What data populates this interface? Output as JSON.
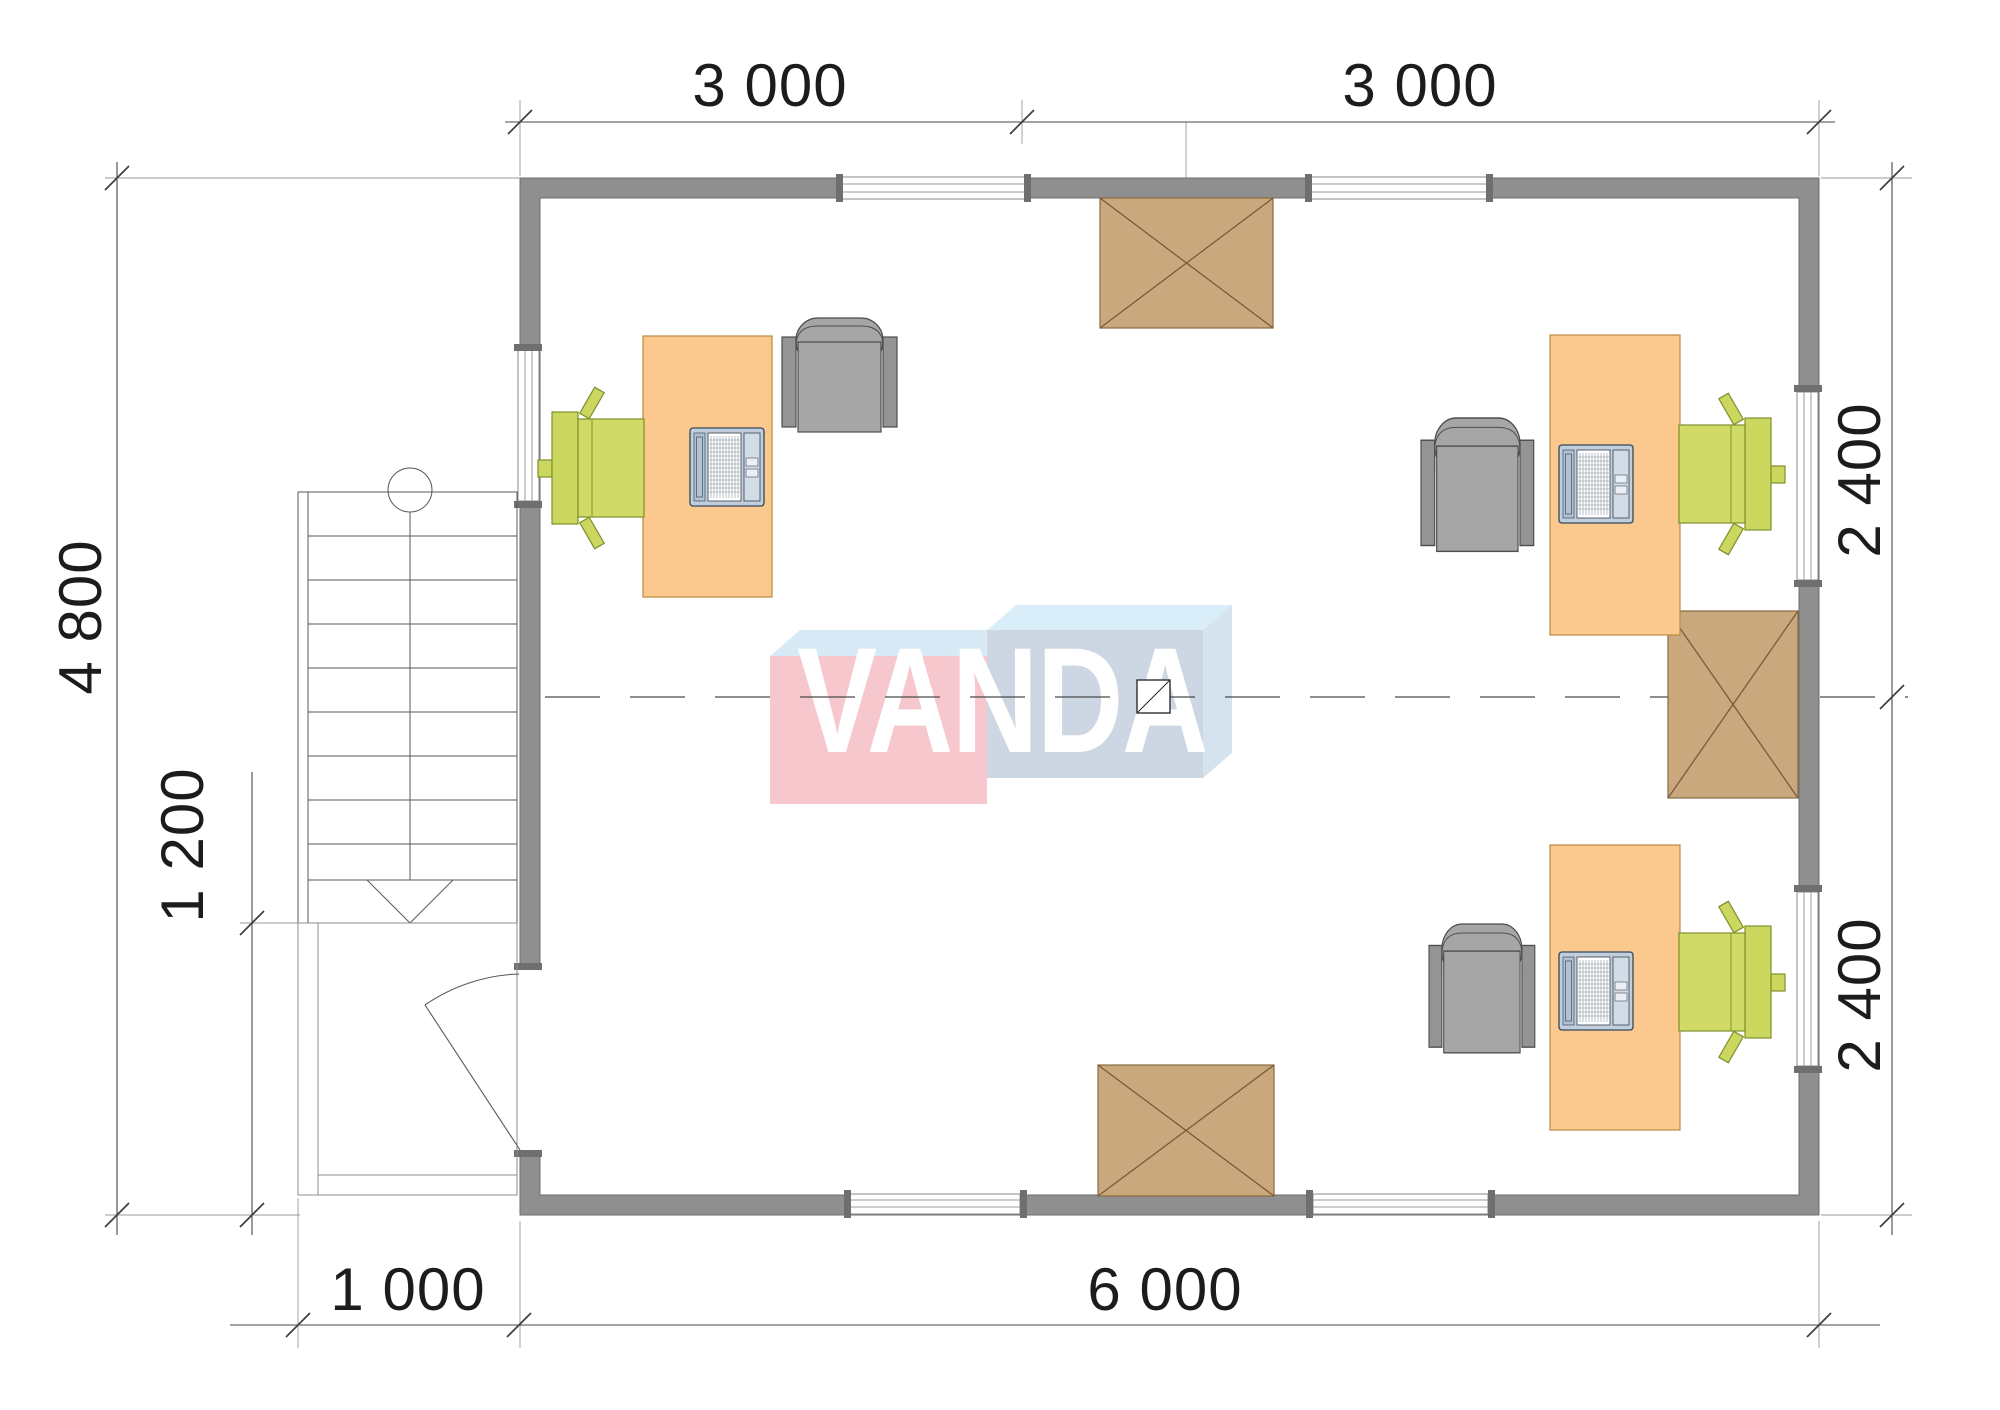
{
  "drawing": {
    "type": "floor-plan",
    "room_count": 1,
    "workstations": 3
  },
  "watermark": {
    "text": "VANDA"
  },
  "dimensions": {
    "top_left": "3 000",
    "top_right": "3 000",
    "right_upper": "2 400",
    "right_lower": "2 400",
    "left": "4 800",
    "left_porch": "1 200",
    "bottom_porch": "1 000",
    "bottom_main": "6 000"
  },
  "colors": {
    "wall": "#8f8f8f",
    "wall_edge": "#6d6d6d",
    "desk": "#fbc98d",
    "desk_edge": "#bb8a41",
    "chair_gray": "#a6a6a6",
    "chair_gray_edge": "#4d4d4d",
    "chair_green": "#ccd75f",
    "chair_green_edge": "#7e8f2c",
    "hatch": "#c9a87e",
    "hatch_line": "#7b5a36",
    "laptop": "#c2cedb",
    "laptop_edge": "#33485c",
    "dim": "#3f3f3f",
    "text": "#1c1c1c",
    "logo_pink": "#f6c8ce",
    "logo_blue": "#ccd7e3",
    "logo_top_left": "#d8eaf6",
    "logo_top_right": "#daeefa",
    "logo_side": "#d5e3ef",
    "logo_text": "#ffffff"
  }
}
